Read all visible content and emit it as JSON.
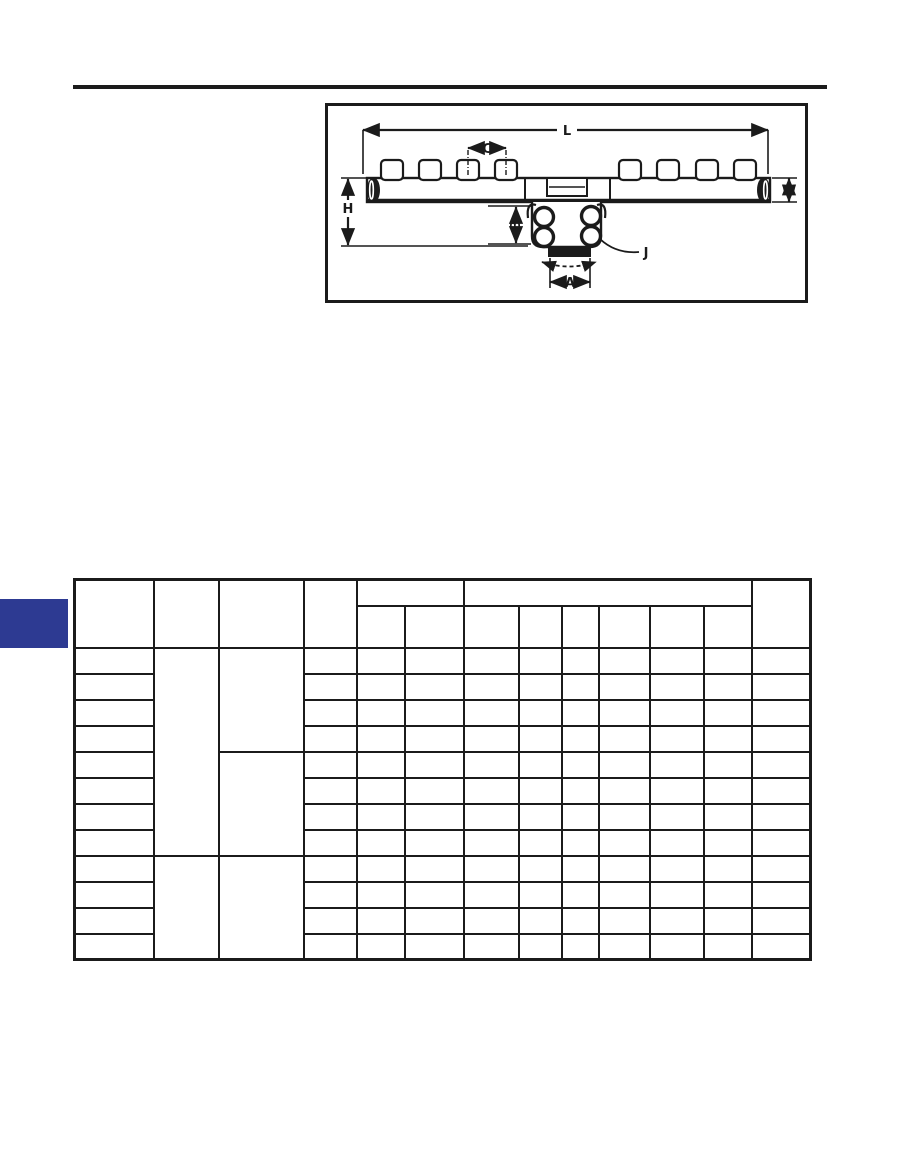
{
  "page": {
    "width_px": 905,
    "height_px": 1175,
    "background": "#ffffff"
  },
  "top_rule": {
    "color": "#1b1b1b"
  },
  "section_tab": {
    "color": "#2d3a92"
  },
  "diagram": {
    "type": "dimensioned outline drawing of a multi-port manifold",
    "border_color": "#1b1b1b",
    "line_color": "#1b1b1b",
    "labels": {
      "L": "L",
      "C": "C",
      "W": "W",
      "H": "H",
      "B": "B",
      "J": "J",
      "A": "A"
    }
  },
  "table": {
    "all_cells_empty": true,
    "column_widths_px": [
      79,
      65,
      85,
      53,
      48,
      59,
      55,
      43,
      37,
      51,
      54,
      48,
      59
    ],
    "header": {
      "top_row_height_px": 26,
      "sub_row_height_px": 42,
      "top_row": [
        {
          "rowspan": 2
        },
        {
          "rowspan": 2
        },
        {
          "rowspan": 2
        },
        {
          "rowspan": 2
        },
        {
          "colspan": 2
        },
        {
          "colspan": 6
        },
        {
          "rowspan": 2
        }
      ],
      "sub_cells": 8
    },
    "body": {
      "row_count": 12,
      "row_height_px": 26,
      "trailing_cols": 10,
      "col2_rowspans": {
        "0": 8,
        "8": 4
      },
      "col3_rowspans": {
        "0": 4,
        "4": 4,
        "8": 4
      }
    }
  }
}
